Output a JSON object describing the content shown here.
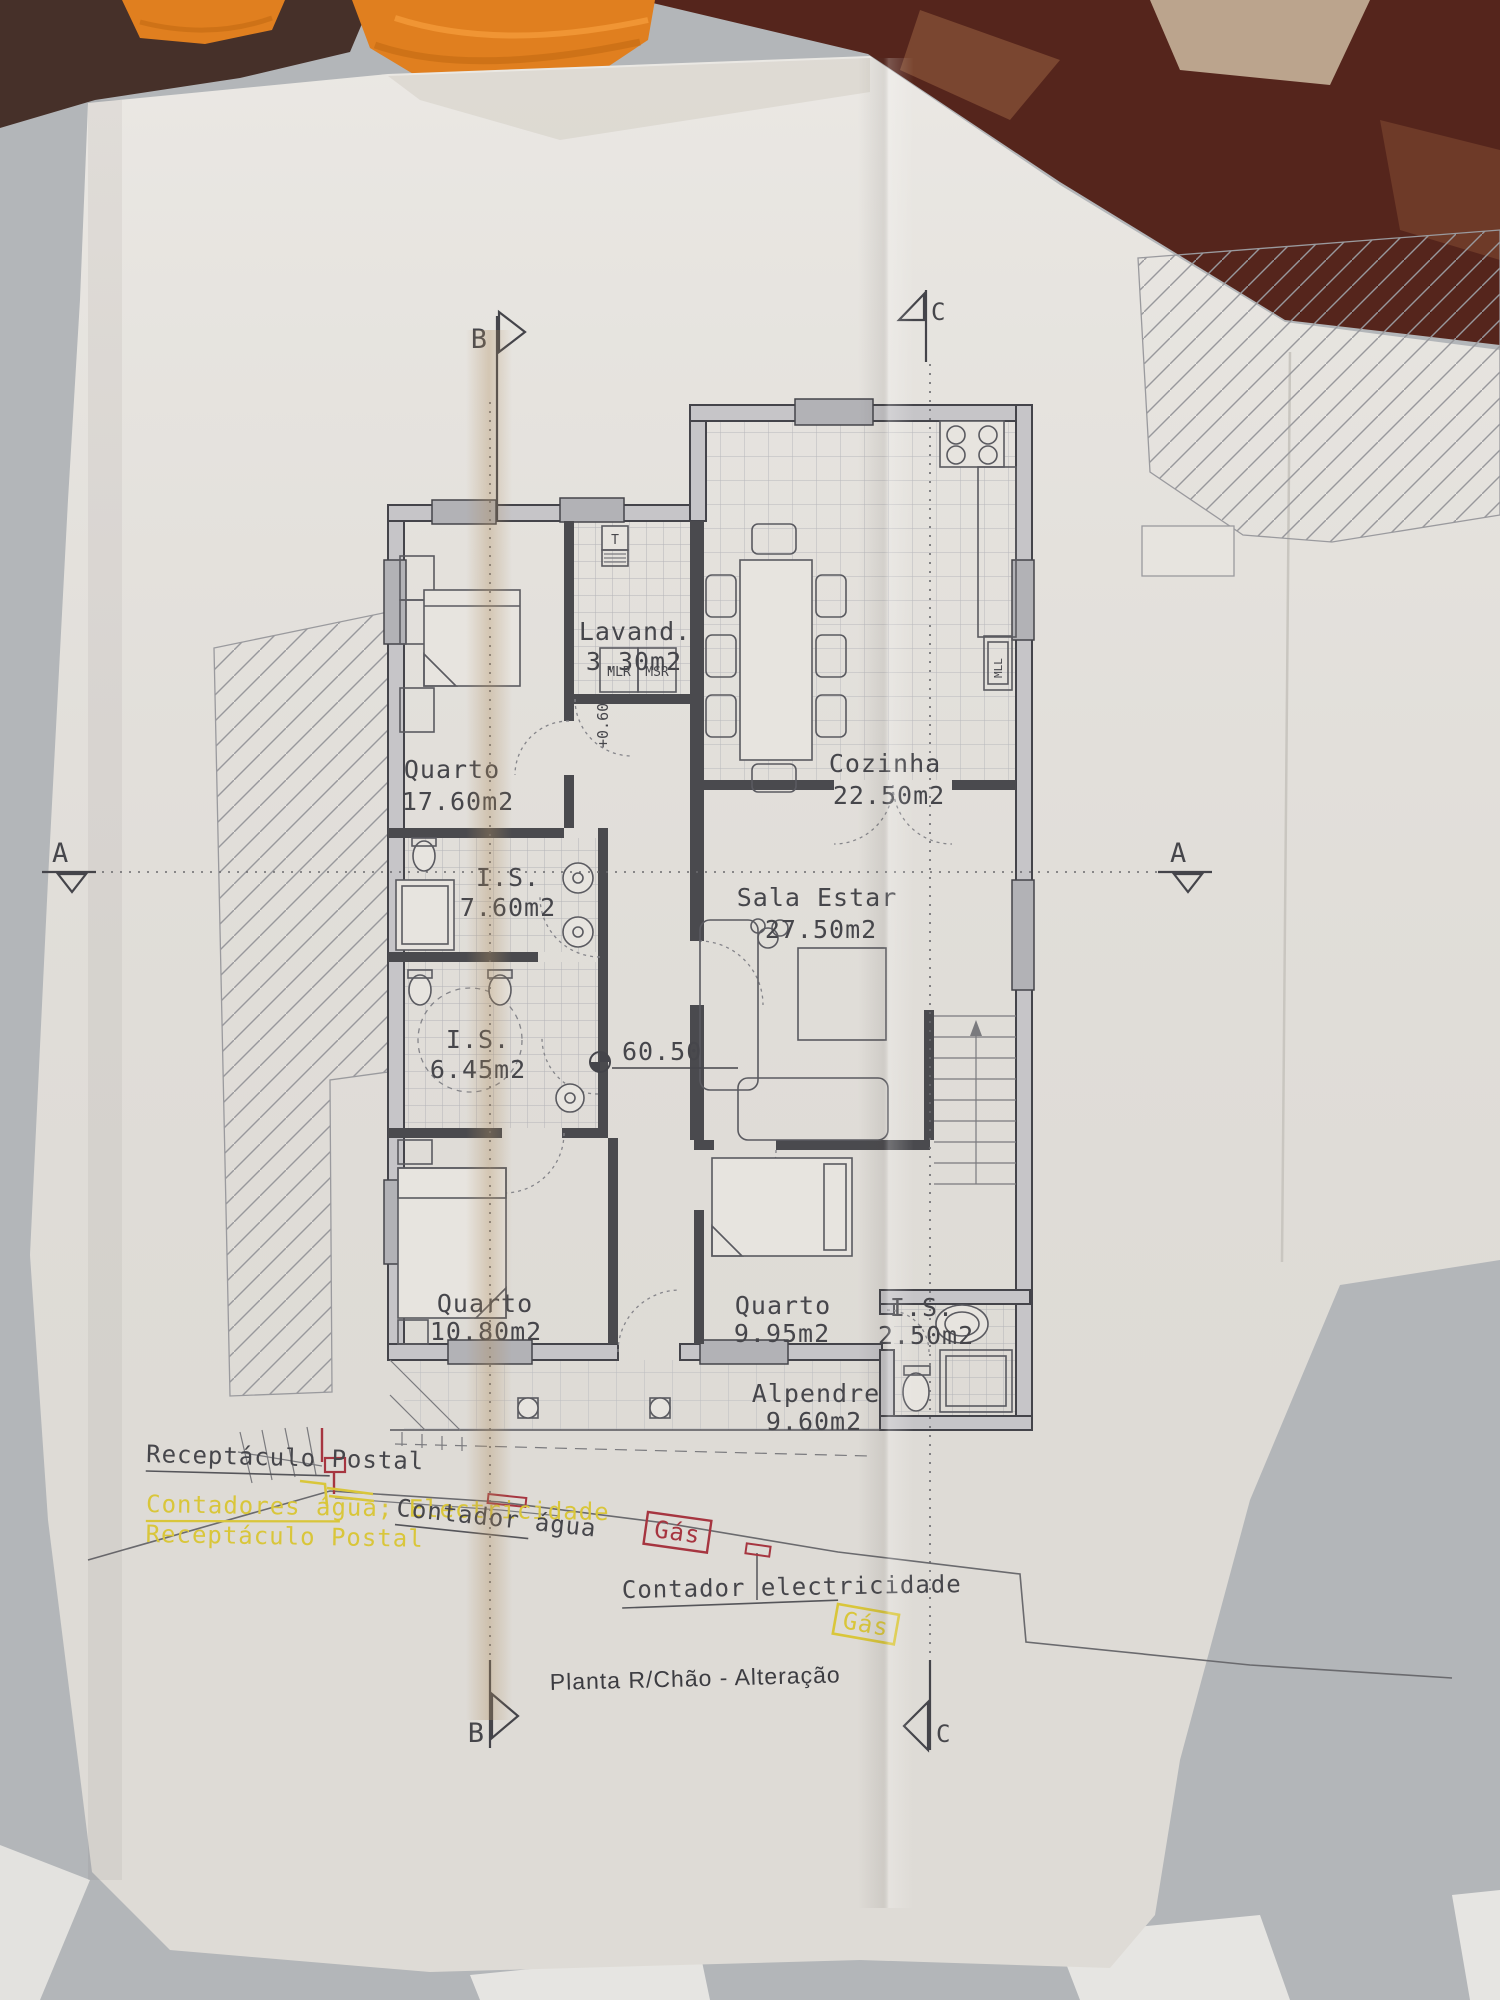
{
  "document": {
    "title": "Planta R/Chão - Alteração"
  },
  "section_markers": {
    "b_top": "B",
    "c_top": "C",
    "a_left": "A",
    "a_right": "A",
    "b_bottom": "B",
    "c_bottom": "C"
  },
  "rooms": {
    "quarto1": {
      "name": "Quarto",
      "area": "17.60m2"
    },
    "lavandaria": {
      "name": "Lavand.",
      "area": "3.30m2"
    },
    "cozinha": {
      "name": "Cozinha",
      "area": "22.50m2"
    },
    "is1": {
      "name": "I.S.",
      "area": "7.60m2"
    },
    "sala": {
      "name": "Sala  Estar",
      "area": "27.50m2"
    },
    "is2": {
      "name": "I.S.",
      "area": "6.45m2"
    },
    "quarto2": {
      "name": "Quarto",
      "area": "10.80m2"
    },
    "quarto3": {
      "name": "Quarto",
      "area": "9.95m2"
    },
    "is3": {
      "name": "I.S.",
      "area": "2.50m2"
    },
    "alpendre": {
      "name": "Alpendre",
      "area": "9.60m2"
    }
  },
  "labels": {
    "t_box": "T",
    "mlr": "MLR",
    "msr": "MSR",
    "mll": "MLL",
    "step_level": "+0.60",
    "floor_level": "60.50"
  },
  "annotations": {
    "receptaculo_postal": "Receptáculo Postal",
    "contadores": "Contadores água; Electricidade",
    "receptaculo_postal_2": "Receptáculo Postal",
    "contador_agua": "Contador água",
    "gas_1": "Gás",
    "contador_electricidade": "Contador electricidade",
    "gas_2": "Gás"
  },
  "colors": {
    "annotation_yellow": "#d9c63a",
    "annotation_red": "#a63540",
    "drawing_ink": "#46464b",
    "paper": "#e7e4df",
    "towel_orange": "#e07f1f",
    "table_brown": "#55251c"
  }
}
